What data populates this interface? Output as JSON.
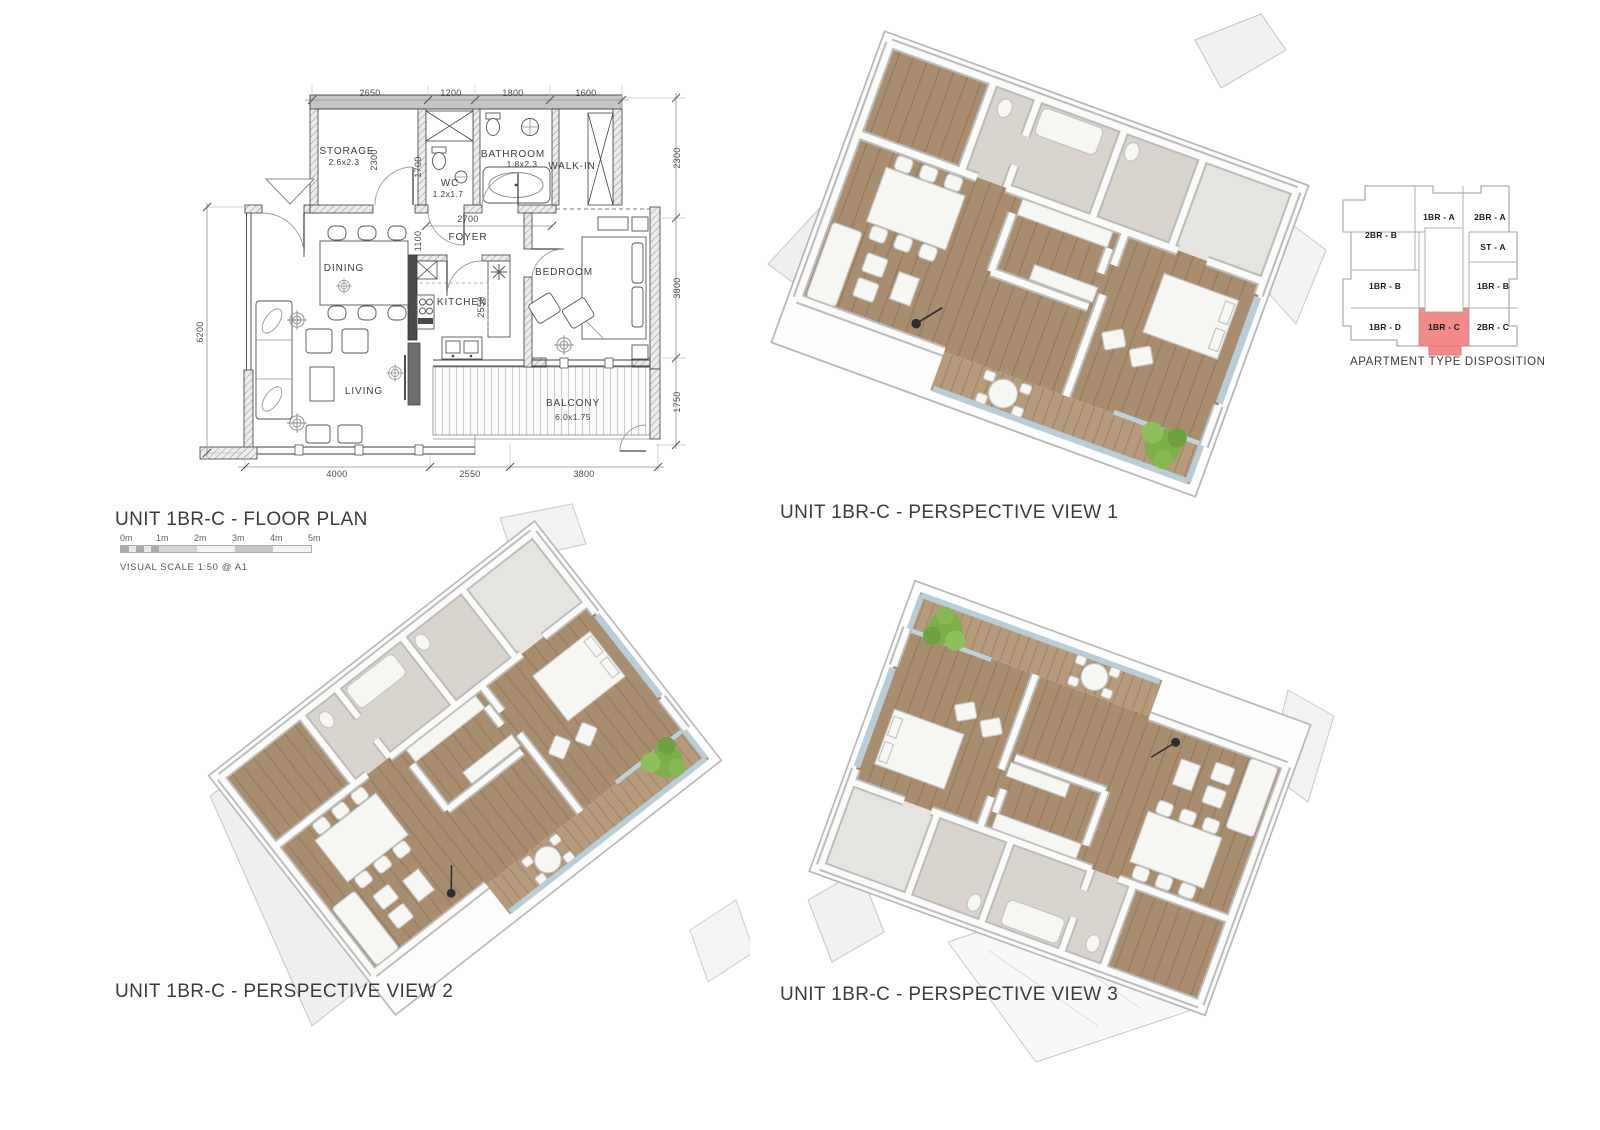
{
  "floor_plan": {
    "title": "UNIT 1BR-C - FLOOR PLAN",
    "scale_note": "VISUAL SCALE 1:50  @ A1",
    "scale_bar_labels": [
      "0m",
      "1m",
      "2m",
      "3m",
      "4m",
      "5m"
    ],
    "rooms": {
      "storage": {
        "name": "STORAGE",
        "size": "2.6x2.3"
      },
      "wc": {
        "name": "WC",
        "size": "1.2x1.7"
      },
      "bathroom": {
        "name": "BATHROOM",
        "size": "1.8x2.3"
      },
      "walkin": {
        "name": "WALK-IN"
      },
      "foyer": {
        "name": "FOYER"
      },
      "dining": {
        "name": "DINING"
      },
      "kitchen": {
        "name": "KITCHEN"
      },
      "bedroom": {
        "name": "BEDROOM"
      },
      "living": {
        "name": "LIVING"
      },
      "balcony": {
        "name": "BALCONY",
        "size": "6.0x1.75"
      }
    },
    "dimensions": {
      "top": [
        "2650",
        "1200",
        "1800",
        "1600"
      ],
      "bottom": [
        "4000",
        "2550",
        "3800"
      ],
      "left": [
        "6200"
      ],
      "right": [
        "2300",
        "3800",
        "1750"
      ],
      "interior": {
        "storage_depth": "2300",
        "hall": "1700",
        "foyer_width": "2700",
        "foyer_depth": "1100",
        "kitchen_depth": "2550"
      }
    }
  },
  "views": {
    "view1": {
      "label": "UNIT 1BR-C - PERSPECTIVE VIEW 1"
    },
    "view2": {
      "label": "UNIT 1BR-C - PERSPECTIVE VIEW 2"
    },
    "view3": {
      "label": "UNIT 1BR-C - PERSPECTIVE VIEW 3"
    }
  },
  "key_plan": {
    "caption": "APARTMENT TYPE DISPOSITION",
    "highlight_color": "#f28a8a",
    "units": [
      {
        "label": "2BR - B",
        "highlighted": false
      },
      {
        "label": "1BR - A",
        "highlighted": false
      },
      {
        "label": "2BR - A",
        "highlighted": false
      },
      {
        "label": "ST - A",
        "highlighted": false
      },
      {
        "label": "1BR - B",
        "highlighted": false
      },
      {
        "label": "1BR - B",
        "highlighted": false
      },
      {
        "label": "1BR - D",
        "highlighted": false
      },
      {
        "label": "1BR - C",
        "highlighted": true
      },
      {
        "label": "2BR - C",
        "highlighted": false
      }
    ]
  },
  "colors": {
    "floor_wood": "#a98d6f",
    "balcony_wood": "#b59a7c",
    "plant_green": "#7cae4a",
    "glass_blue": "#b7cdd8",
    "highlight_red": "#f28a8a"
  }
}
